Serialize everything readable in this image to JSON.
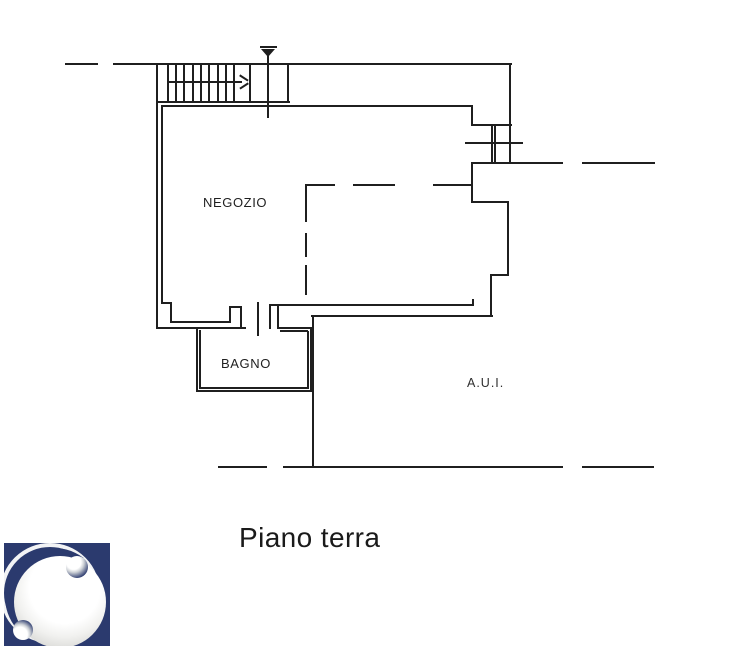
{
  "title": {
    "text": "Piano terra"
  },
  "rooms": {
    "negozio": {
      "label": "NEGOZIO"
    },
    "bagno": {
      "label": "BAGNO"
    },
    "aui": {
      "label": "A.U.I."
    }
  },
  "colors": {
    "line": "#1f1f1f",
    "background": "#ffffff",
    "logo_navy": "#2b3a6e",
    "sphere_white": "#f5f5f3"
  },
  "symbols": {
    "stair_direction_arrow": "right",
    "vent_symbol": "inverted-triangle-on-stem"
  },
  "geometry": {
    "h_lines": [
      [
        65,
        63,
        33
      ],
      [
        113,
        63,
        399
      ],
      [
        158,
        101,
        132
      ],
      [
        161,
        105,
        312
      ],
      [
        167,
        81,
        75
      ],
      [
        465,
        142,
        58,
        1.6
      ],
      [
        471,
        124,
        41
      ],
      [
        471,
        162,
        92
      ],
      [
        582,
        162,
        73
      ],
      [
        471,
        201,
        38
      ],
      [
        490,
        274,
        19
      ],
      [
        269,
        304,
        205
      ],
      [
        311,
        315,
        182
      ],
      [
        161,
        302,
        10
      ],
      [
        170,
        321,
        61
      ],
      [
        156,
        327,
        90
      ],
      [
        229,
        306,
        13
      ],
      [
        277,
        327,
        36
      ],
      [
        280,
        330,
        28
      ],
      [
        196,
        390,
        117
      ],
      [
        199,
        387,
        110
      ],
      [
        218,
        466,
        49
      ],
      [
        283,
        466,
        280
      ],
      [
        582,
        466,
        72
      ]
    ],
    "v_lines": [
      [
        156,
        63,
        265
      ],
      [
        161,
        105,
        198
      ],
      [
        249,
        63,
        40
      ],
      [
        287,
        63,
        40
      ],
      [
        267,
        55,
        63,
        1.6
      ],
      [
        509,
        63,
        100
      ],
      [
        471,
        105,
        20
      ],
      [
        491,
        124,
        39,
        1.6
      ],
      [
        494,
        124,
        39,
        1.6
      ],
      [
        471,
        162,
        40
      ],
      [
        507,
        201,
        74
      ],
      [
        490,
        274,
        42
      ],
      [
        472,
        299,
        6
      ],
      [
        170,
        302,
        20
      ],
      [
        229,
        306,
        16
      ],
      [
        240,
        306,
        22
      ],
      [
        257,
        302,
        34
      ],
      [
        269,
        304,
        25
      ],
      [
        277,
        304,
        25
      ],
      [
        196,
        327,
        64
      ],
      [
        199,
        330,
        58
      ],
      [
        307,
        331,
        57
      ],
      [
        310,
        327,
        64
      ],
      [
        312,
        315,
        153
      ]
    ],
    "stair_treads": {
      "xs": [
        167,
        175,
        183,
        192,
        200,
        208,
        217,
        225,
        233
      ],
      "y": 63,
      "h": 40
    },
    "dashed_h_segments": [
      [
        305,
        184,
        30
      ],
      [
        353,
        184,
        42
      ],
      [
        433,
        184,
        39
      ]
    ],
    "dashed_v_segments": [
      [
        305,
        184,
        38
      ],
      [
        305,
        233,
        24
      ],
      [
        305,
        265,
        30
      ]
    ]
  }
}
